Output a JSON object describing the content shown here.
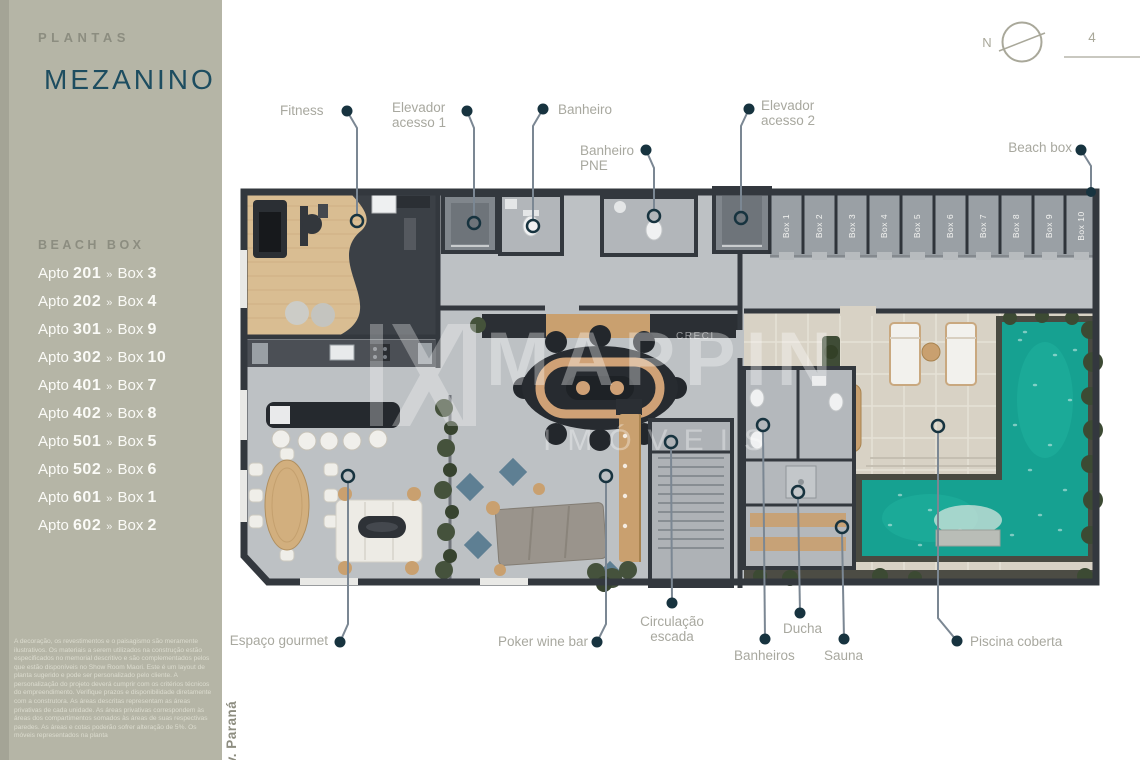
{
  "sidebar": {
    "section_label": "PLANTAS",
    "title": "MEZANINO",
    "beach_box": {
      "heading": "BEACH BOX",
      "apto_prefix": "Apto",
      "box_prefix": "Box",
      "separator": "»",
      "items": [
        {
          "apto": "201",
          "box": "3"
        },
        {
          "apto": "202",
          "box": "4"
        },
        {
          "apto": "301",
          "box": "9"
        },
        {
          "apto": "302",
          "box": "10"
        },
        {
          "apto": "401",
          "box": "7"
        },
        {
          "apto": "402",
          "box": "8"
        },
        {
          "apto": "501",
          "box": "5"
        },
        {
          "apto": "502",
          "box": "6"
        },
        {
          "apto": "601",
          "box": "1"
        },
        {
          "apto": "602",
          "box": "2"
        }
      ]
    },
    "disclaimer": "A decoração, os revestimentos e o paisagismo são meramente ilustrativos. Os materiais a serem utilizados na construção estão especificados no memorial descritivo e são complementados pelos que estão disponíveis no Show Room Maori. Este é um layout de planta sugerido e pode ser personalizado pelo cliente. A personalização do projeto deverá cumprir com os critérios técnicos do empreendimento. Verifique prazos e disponibilidade diretamente com a construtora. As áreas descritas representam as áreas privativas de cada unidade. As áreas privativas correspondem às áreas dos compartimentos somados às áreas de suas respectivas paredes. As áreas e cotas poderão sofrer alteração de 5%. Os móveis representados na planta",
    "street_label": "Av. Paraná"
  },
  "header": {
    "compass_label": "N",
    "page_number": "4"
  },
  "watermark": {
    "brand": "MAPPIN",
    "subtitle": "IMÓVEIS",
    "creci": "CRECI"
  },
  "plan": {
    "labels": {
      "fitness": "Fitness",
      "elevator1": "Elevador\nacesso 1",
      "banheiro": "Banheiro",
      "banheiro_pne": "Banheiro\nPNE",
      "elevator2": "Elevador\nacesso 2",
      "beach_box": "Beach box",
      "espaco_gourmet": "Espaço gourmet",
      "poker_wine_bar": "Poker wine bar",
      "circulacao_escada": "Circulação\nescada",
      "banheiros": "Banheiros",
      "ducha": "Ducha",
      "sauna": "Sauna",
      "piscina_coberta": "Piscina coberta"
    },
    "boxes": [
      "Box 1",
      "Box 2",
      "Box 3",
      "Box 4",
      "Box 5",
      "Box 6",
      "Box 7",
      "Box 8",
      "Box 9",
      "Box 10"
    ]
  },
  "colors": {
    "sidebar_bg": "#b5b5a6",
    "title_teal": "#1d4d60",
    "label_gray": "#a8a89f",
    "leader_dot": "#17333f",
    "wall": "#33383e",
    "floor": "#bdc1c4",
    "wood": "#d9bd92",
    "pool": "#16a191",
    "deck": "#d8d2c5",
    "green": "#3c4a33"
  }
}
